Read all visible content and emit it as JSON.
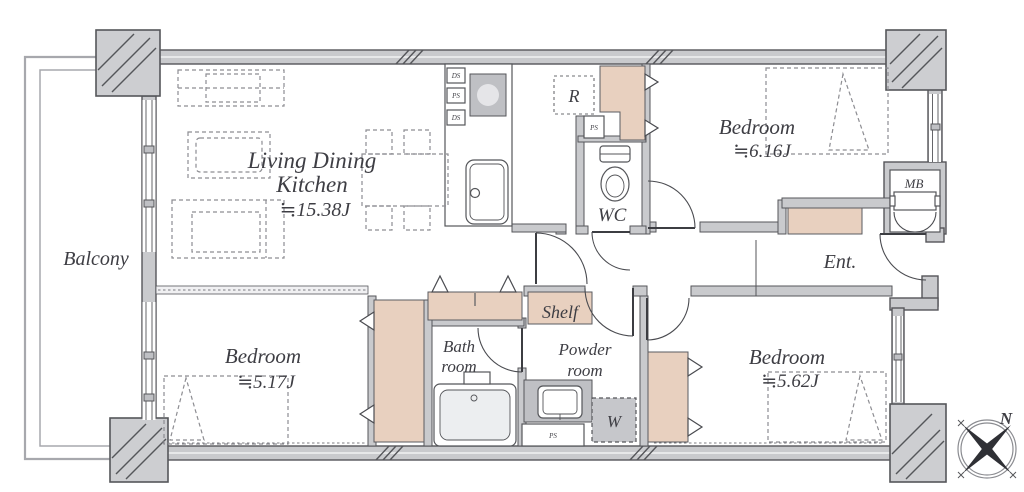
{
  "title": "Apartment floor plan",
  "rooms": {
    "balcony": {
      "name": "Balcony"
    },
    "ldk": {
      "name_line1": "Living Dining",
      "name_line2": "Kitchen",
      "area": "≒15.38J"
    },
    "bedroom_ne": {
      "name": "Bedroom",
      "area": "≒6.16J"
    },
    "bedroom_sw": {
      "name": "Bedroom",
      "area": "≒5.17J"
    },
    "bedroom_se": {
      "name": "Bedroom",
      "area": "≒5.62J"
    },
    "wc": {
      "name": "WC"
    },
    "entrance": {
      "name": "Ent."
    },
    "shelf": {
      "name": "Shelf"
    },
    "bath": {
      "name_line1": "Bath",
      "name_line2": "room"
    },
    "powder": {
      "name_line1": "Powder",
      "name_line2": "room"
    }
  },
  "tags": {
    "meter_box": "MB",
    "refrigerator": "R",
    "washer": "W",
    "pipe_space": "PS",
    "duct_space": "DS"
  },
  "compass": {
    "north": "N"
  },
  "colors": {
    "wall_fill": "#c9cacd",
    "wall_outline": "#55565a",
    "storage_fill": "#e8d0bf",
    "fixture_gray": "#bfc0c4",
    "dash_gray": "#8d8d92",
    "background": "#ffffff"
  }
}
